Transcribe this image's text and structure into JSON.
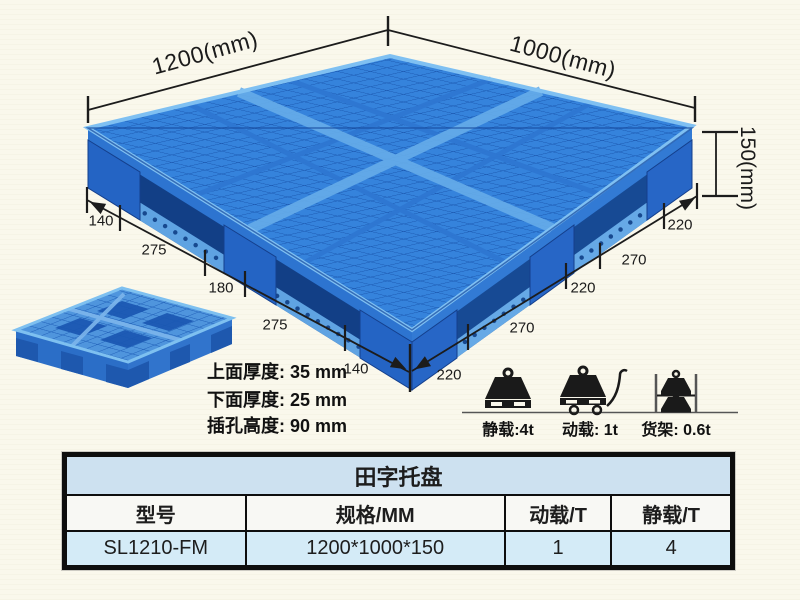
{
  "diagram": {
    "dims": {
      "length": "1200(mm)",
      "width": "1000(mm)",
      "height": "150(mm)"
    },
    "left_chain": [
      "140",
      "275",
      "180",
      "275",
      "140"
    ],
    "right_chain": [
      "220",
      "270",
      "220",
      "270",
      "220"
    ],
    "notes": [
      "上面厚度: 35 mm",
      "下面厚度: 25 mm",
      "插孔高度: 90 mm"
    ],
    "loads": [
      {
        "icon": "static-load-icon",
        "label": "静载:4t"
      },
      {
        "icon": "dynamic-load-icon",
        "label": "动载: 1t"
      },
      {
        "icon": "rack-load-icon",
        "label": "货架: 0.6t"
      }
    ],
    "colors": {
      "pallet_blue": "#3583dc",
      "pallet_dark_blue": "#1b58b0",
      "pallet_light_blue": "#7fc0f2",
      "dimension_line": "#1c1c1c"
    }
  },
  "table": {
    "title": "田字托盘",
    "headers": [
      "型号",
      "规格/MM",
      "动载/T",
      "静载/T"
    ],
    "rows": [
      [
        "SL1210-FM",
        "1200*1000*150",
        "1",
        "4"
      ]
    ]
  }
}
